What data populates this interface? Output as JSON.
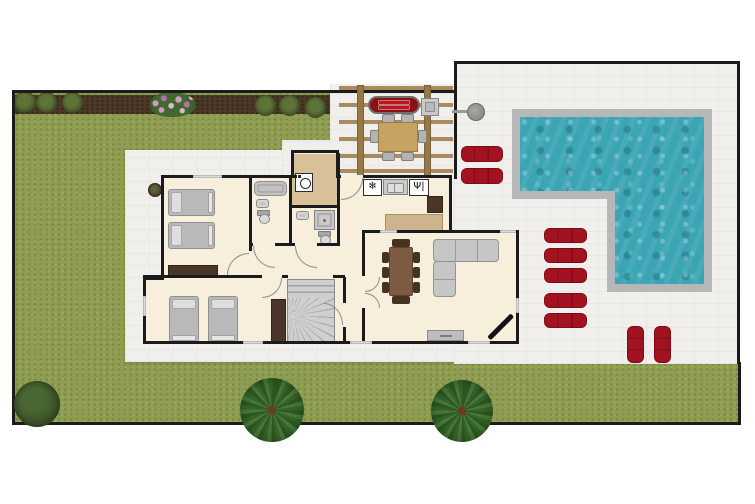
{
  "scene": {
    "kind": "residential floor plan, top-down site view",
    "canvas": {
      "width": 755,
      "height": 504
    }
  },
  "palette": {
    "page_bg": "#ffffff",
    "border_black": "#1b1b1b",
    "grass": "#8e9d52",
    "soil": "#4c3826",
    "concrete": "#f1efeb",
    "pool_deck": "#b7b7b7",
    "pool_water": "#3ba5b4",
    "wall": "#1b1b1b",
    "floor": "#f7efdb",
    "floor_tan": "#d8c099",
    "counter": "#cdb48c",
    "wood_dark": "#4a3628",
    "furn_gray": "#c6c6c6",
    "bed_gray": "#b9b9b9",
    "pillow": "#dedede",
    "table_brown": "#7d5a43",
    "chair_brown": "#46331f",
    "outdoor_table": "#c7a363",
    "pergola": "#a98b5e",
    "lounger": "#a31220",
    "lounger_dark": "#7c0c18",
    "bbq_red": "#8e1016",
    "bbq_stripe": "#c2121d",
    "tv_black": "#121212",
    "stairs": "#cfcfcf",
    "stairs_line": "#a2a2a2",
    "window": "#dcdcdc",
    "tree_green": "#47793a",
    "tree_green_dark": "#2e5722",
    "bush_dark": "#3c5429",
    "flower_pink": "#cf9cc4",
    "flower_pink2": "#b671a8"
  },
  "icons": {
    "fridge_glyph": "❄",
    "stove_glyph": "Ψ|"
  },
  "site": {
    "garden": {
      "soil_bed_bushes_left": 3,
      "soil_bed_bushes_center": 3,
      "flower_patches": 1,
      "shrub_bottom_left": 1,
      "palm_trees": 2,
      "potted_plant": 1
    },
    "patio": {
      "pool_shape": "L-shaped",
      "outdoor_shower": 1,
      "sun_loungers_left_pair": 2,
      "sun_loungers_center_stack": 5,
      "sun_loungers_bottom_pair": 2
    },
    "pergola": {
      "bbq_grill": 1,
      "side_table": 1,
      "outdoor_dining_chairs": 6
    }
  },
  "house": {
    "rooms": [
      {
        "name": "bedroom-1",
        "furniture": [
          "single bed",
          "single bed",
          "dresser"
        ]
      },
      {
        "name": "bathroom",
        "furniture": [
          "bathtub",
          "sink",
          "toilet"
        ]
      },
      {
        "name": "laundry",
        "furniture": [
          "washing machine"
        ]
      },
      {
        "name": "shower-room",
        "furniture": [
          "sink",
          "shower",
          "toilet"
        ]
      },
      {
        "name": "kitchen",
        "furniture": [
          "fridge-freezer",
          "double sink",
          "cooktop",
          "counter",
          "tall cabinet"
        ]
      },
      {
        "name": "hallway",
        "furniture": []
      },
      {
        "name": "staircase",
        "furniture": [
          "winder stairs"
        ]
      },
      {
        "name": "bedroom-2",
        "furniture": [
          "single bed",
          "single bed",
          "wardrobe"
        ]
      },
      {
        "name": "living-room",
        "furniture": [
          "dining table",
          "8 chairs",
          "corner sofa",
          "tv stand",
          "corner tv"
        ]
      }
    ]
  }
}
